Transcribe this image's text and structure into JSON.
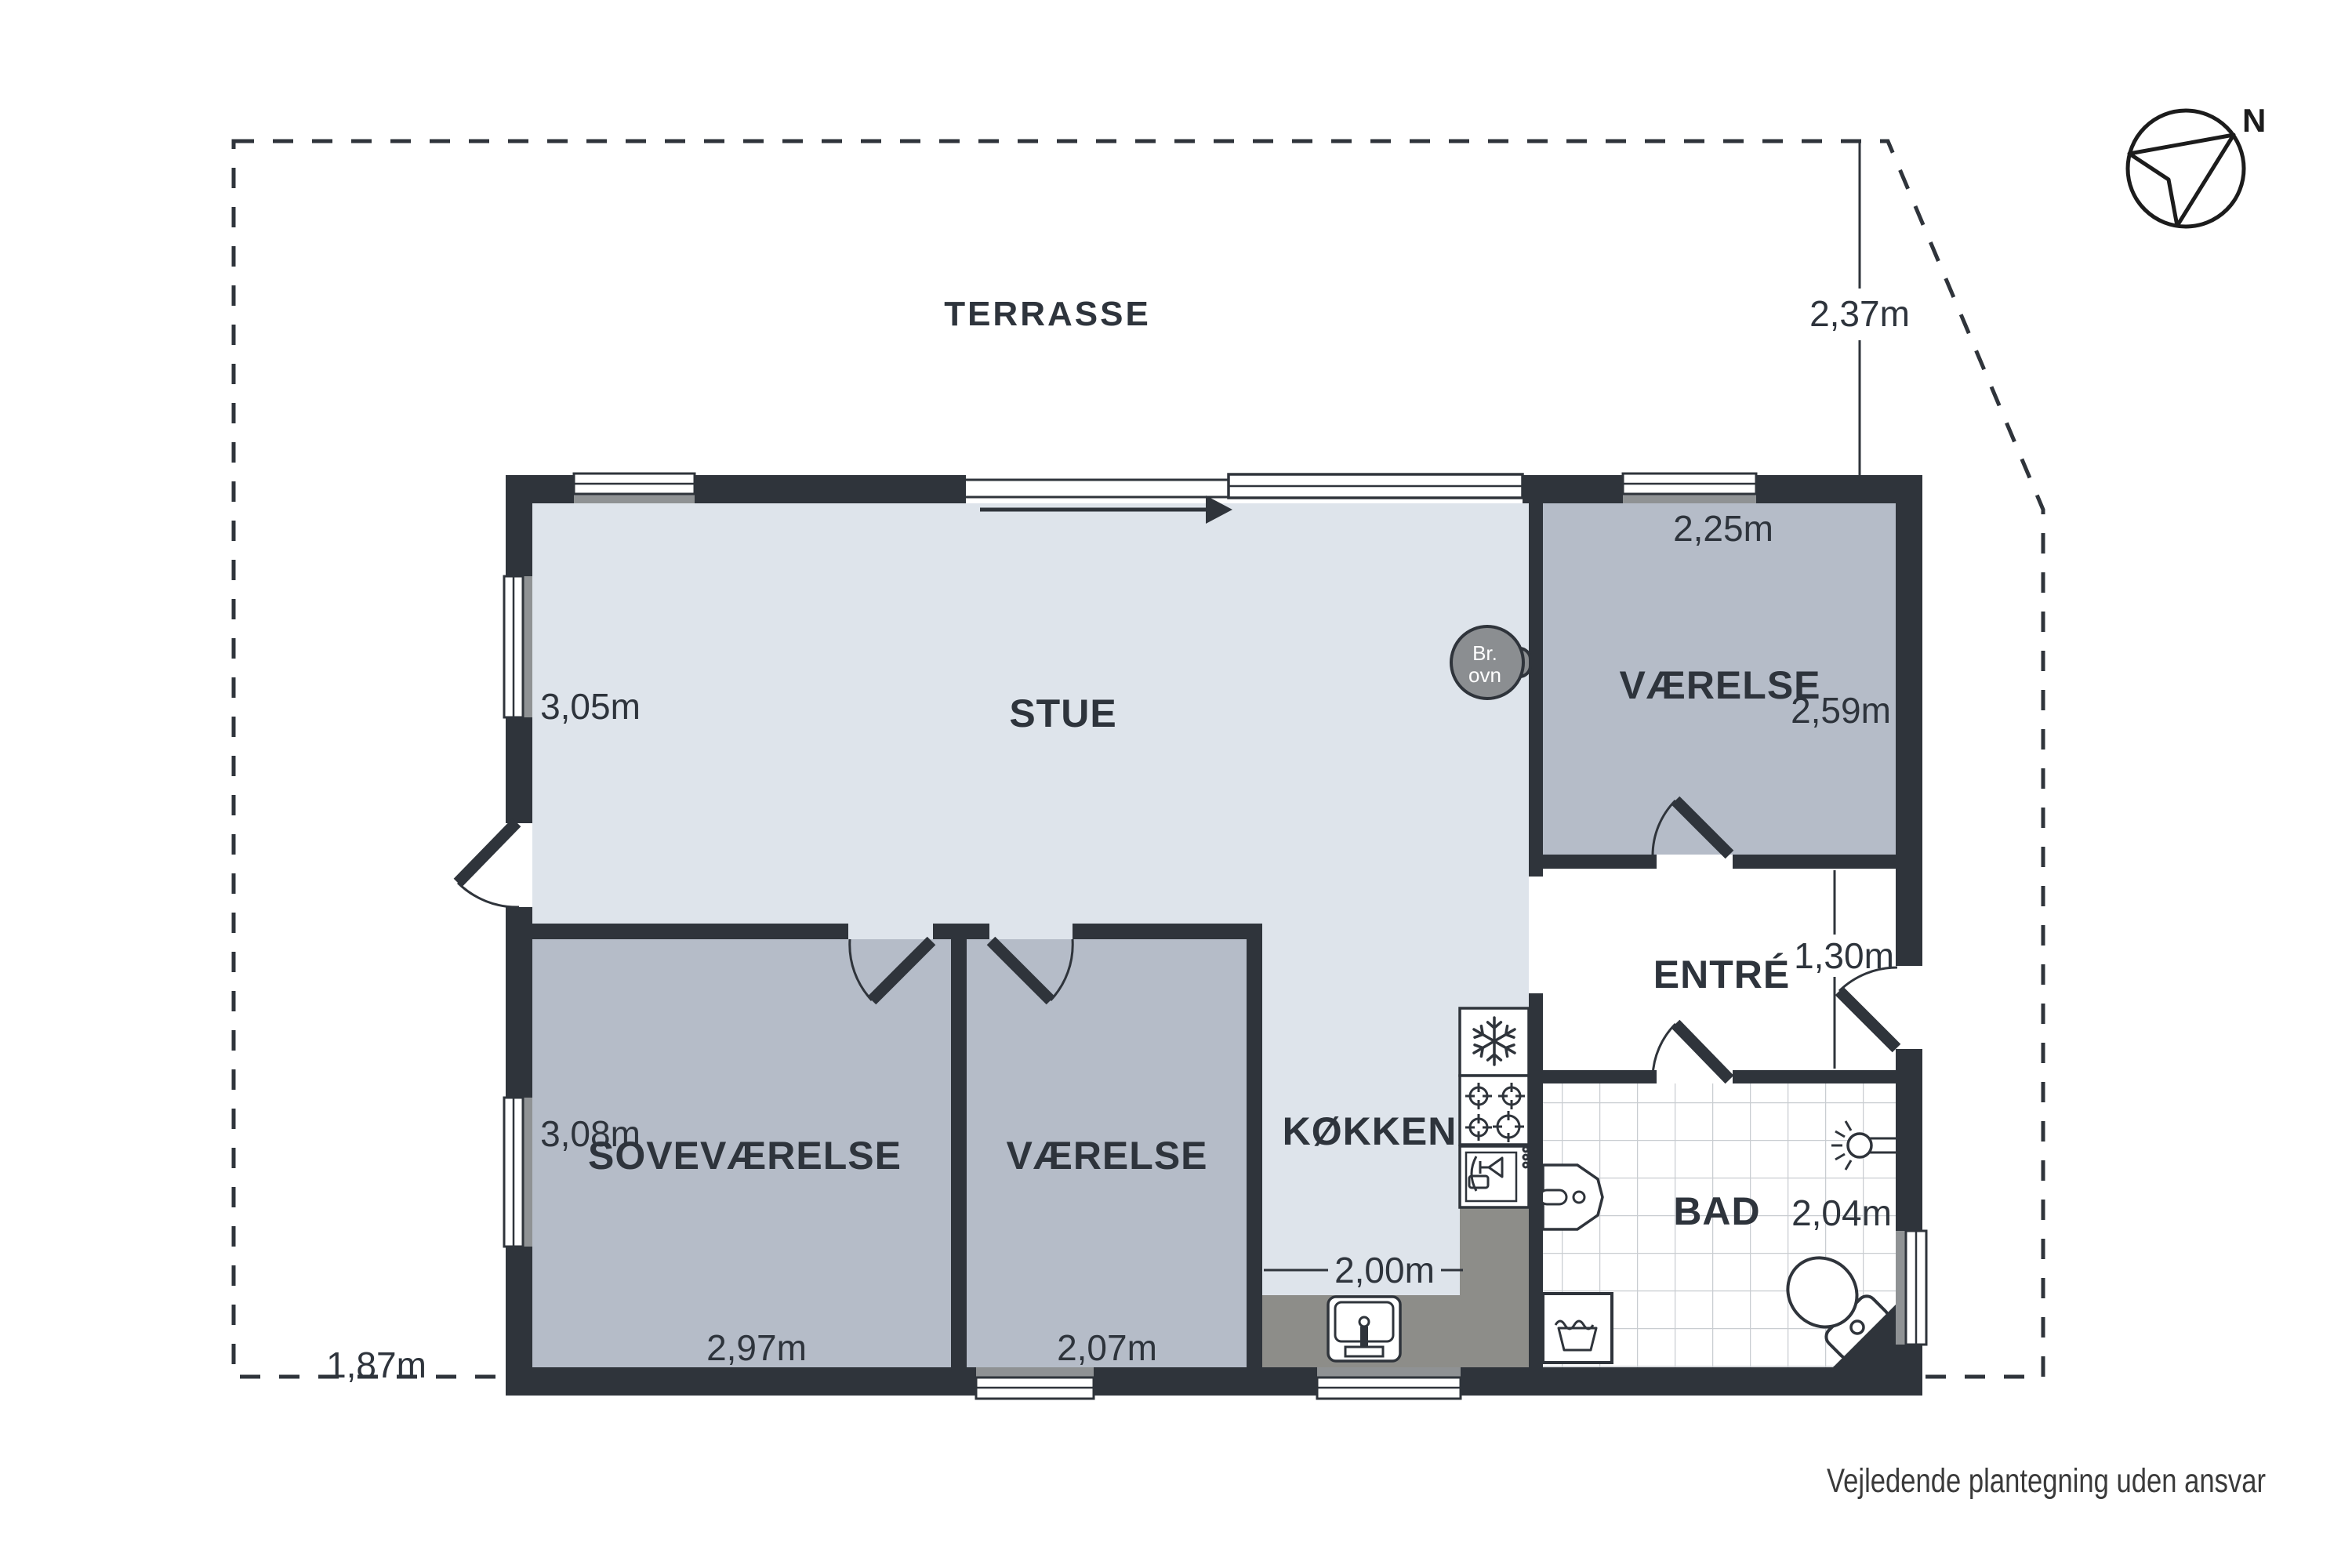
{
  "colors": {
    "wall": "#2f343b",
    "floor-light": "#dee4eb",
    "floor-room": "#b5bcc8",
    "counter": "#8d8d89",
    "sill": "#8f9294",
    "stove": "#8b8e91",
    "tile-line": "#c9cdd1",
    "text": "#2e343c",
    "muted-text": "#3a3a3a"
  },
  "compass": {
    "label": "N"
  },
  "terrace": {
    "label": "TERRASSE"
  },
  "rooms": {
    "stue": {
      "label": "STUE"
    },
    "koekken": {
      "label": "KØKKEN"
    },
    "sovevaerelse": {
      "label": "SOVEVÆRELSE"
    },
    "vaerelse_mid": {
      "label": "VÆRELSE"
    },
    "vaerelse_ne": {
      "label": "VÆRELSE"
    },
    "entre": {
      "label": "ENTRÉ"
    },
    "bad": {
      "label": "BAD"
    }
  },
  "measurements": {
    "terrace_right": "2,37m",
    "terrace_left": "1,87m",
    "stue_height": "3,05m",
    "vaerelse_ne_width": "2,25m",
    "vaerelse_ne_height": "2,59m",
    "entre_height": "1,30m",
    "sovevaerelse_height": "3,08m",
    "sovevaerelse_width": "2,97m",
    "vaerelse_mid_width": "2,07m",
    "koekken_width": "2,00m",
    "bad_height": "2,04m"
  },
  "fixtures": {
    "wood_stove": {
      "line1": "Br.",
      "line2": "ovn"
    }
  },
  "footer": {
    "disclaimer": "Vejledende plantegning uden ansvar"
  }
}
